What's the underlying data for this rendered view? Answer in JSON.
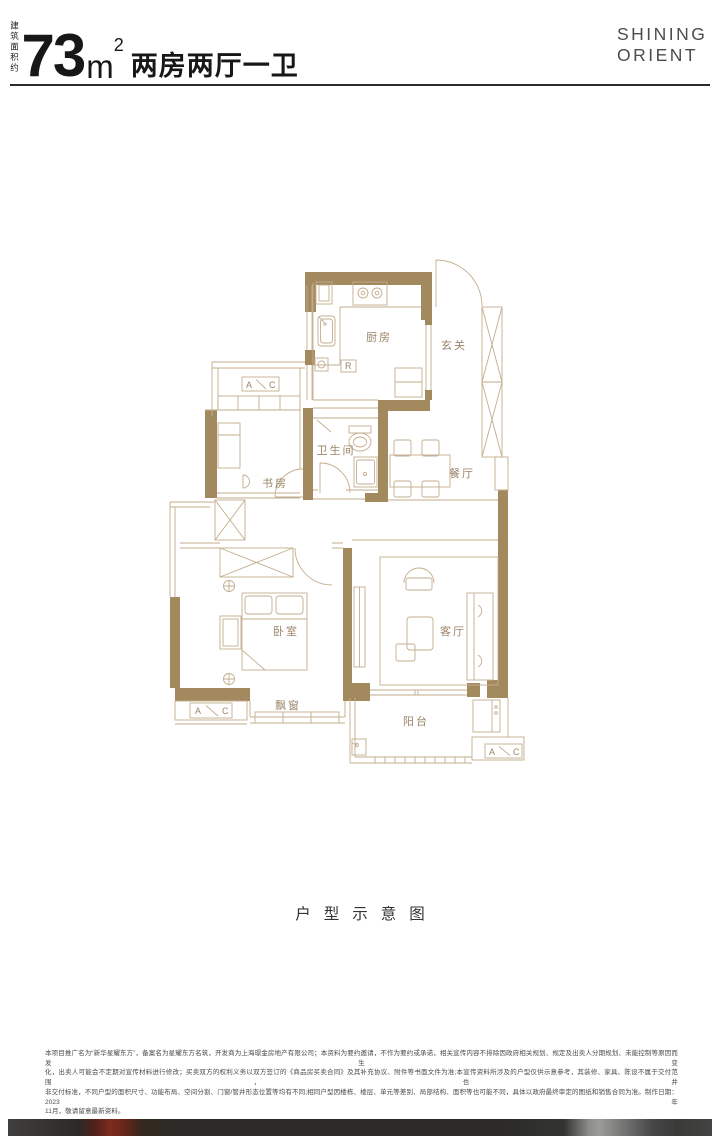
{
  "header": {
    "area_label_vertical": "建筑面积约",
    "area_value": "73",
    "area_unit": "m",
    "area_unit_sup": "2",
    "layout_title": "两房两厅一卫",
    "brand": {
      "line1": "SHINING",
      "line2": "ORIENT"
    }
  },
  "floorplan": {
    "rooms": {
      "kitchen": "厨房",
      "foyer": "玄关",
      "bathroom": "卫生间",
      "study": "书房",
      "dining": "餐厅",
      "bedroom": "卧室",
      "living": "客厅",
      "bay_window": "飘窗",
      "balcony": "阳台"
    },
    "markers": {
      "a": "A",
      "c": "C",
      "r": "R"
    }
  },
  "caption": "户型示意图",
  "disclaimer": {
    "lines": [
      "本项目推广名为“新华星耀东方”，备案名为星耀东方名筑，开发商为上海璟金房地产有限公司；本资料为要约邀请，不作为要约或承诺，相关宣传内容不排除因政府相关规划、规定及出卖人分期规划、未能控制等原因而发生变",
      "化，出卖人可能会不定期对宣传材料进行修改；买卖双方的权利义务以双方签订的《商品房买卖合同》及其补充协议、附件等书面文件为准;本宣传资料所涉及的户型仅供示意参考，其装修、家具、陈设不属于交付范围，也并",
      "非交付标准，不同户型的面积尺寸、功能布局、空间分割、门窗/管井形态位置等均有不同;相同户型因楼栋、楼层、单元等差别、局部结构、面积等也可能不同，具体以政府最终审定的图纸和销售合同为准。制作日期：2023年",
      "11月，敬请留意最新资料。"
    ]
  },
  "colors": {
    "wall": "#a2895e",
    "line": "#c3ad8e",
    "room_label": "#9a8468",
    "title": "#171717",
    "brand": "#4d4d4d",
    "footer_red": "#7c2c1e",
    "footer_dark": "#2b2a28"
  }
}
